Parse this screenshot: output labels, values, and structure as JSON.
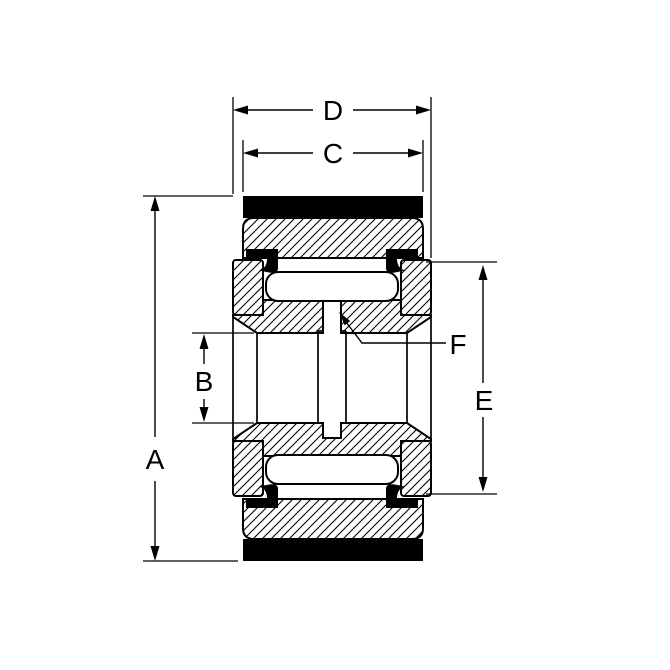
{
  "drawing": {
    "kind": "yoke-track-roller-bearing-cross-section",
    "labels": {
      "A": "A",
      "B": "B",
      "C": "C",
      "D": "D",
      "E": "E",
      "F": "F"
    },
    "colors": {
      "line": "#000000",
      "solid_fill": "#000000",
      "background": "#ffffff"
    }
  }
}
